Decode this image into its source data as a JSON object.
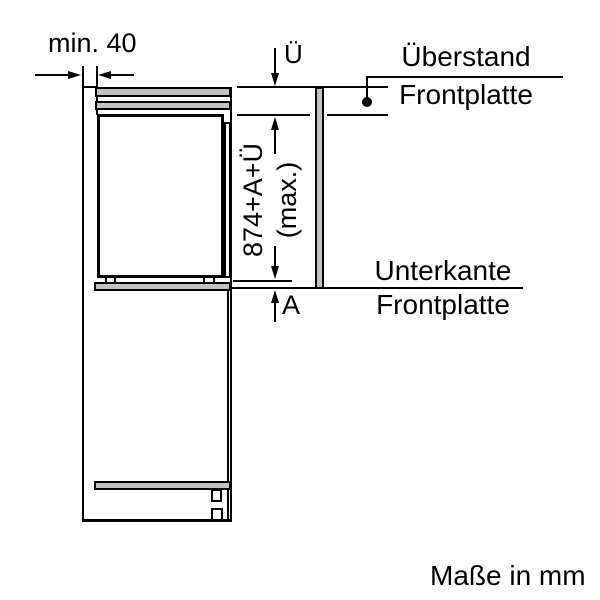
{
  "diagram": {
    "caption": "Maße in mm",
    "labels": {
      "min_gap": "min. 40",
      "ue_dim": "Ü",
      "a_dim": "A",
      "front_panel_height_line1": "874+A+Ü",
      "front_panel_height_line2": "(max.)",
      "ueberstand_line1": "Überstand",
      "ueberstand_line2": "Frontplatte",
      "unterkante_line1": "Unterkante",
      "unterkante_line2": "Frontplatte"
    },
    "colors": {
      "line": "#000000",
      "panel_fill": "#c2c2c2",
      "background": "#ffffff"
    }
  }
}
